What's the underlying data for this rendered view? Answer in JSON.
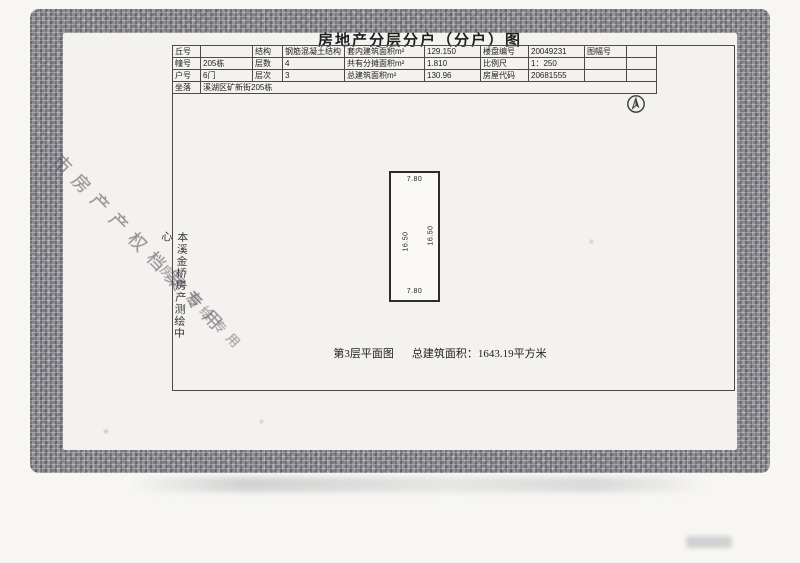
{
  "document": {
    "title": "房地产分层分户（分户）图",
    "caption_plan": "第3层平面图",
    "caption_area": "总建筑面积：1643.19平方米"
  },
  "info_table": {
    "rows": [
      [
        "丘号",
        "",
        "结构",
        "钢筋混凝土结构",
        "套内建筑面积m²",
        "129.150",
        "楼盘编号",
        "20049231",
        "图幅号",
        ""
      ],
      [
        "幢号",
        "205栋",
        "层数",
        "4",
        "共有分摊面积m²",
        "1.810",
        "比例尺",
        "1：250",
        "",
        ""
      ],
      [
        "户号",
        "6门",
        "层次",
        "3",
        "总建筑面积m²",
        "130.96",
        "房屋代码",
        "20681555",
        "",
        ""
      ],
      [
        "坐落",
        "溪湖区矿新街205栋"
      ]
    ]
  },
  "plan": {
    "dim_top": "7.80",
    "dim_bottom": "7.80",
    "dim_left": "16.50",
    "dim_right": "16.50"
  },
  "watermarks": {
    "vertical_mark": "本溪金桥房产测绘中心",
    "diagonal_stamp_1": "市房产产权档案专用",
    "diagonal_stamp_2": "房产测绘专用"
  },
  "colors": {
    "frame_gray": "#8f8d94",
    "page": "#f4f2ee",
    "ink": "#2b2b2b"
  }
}
